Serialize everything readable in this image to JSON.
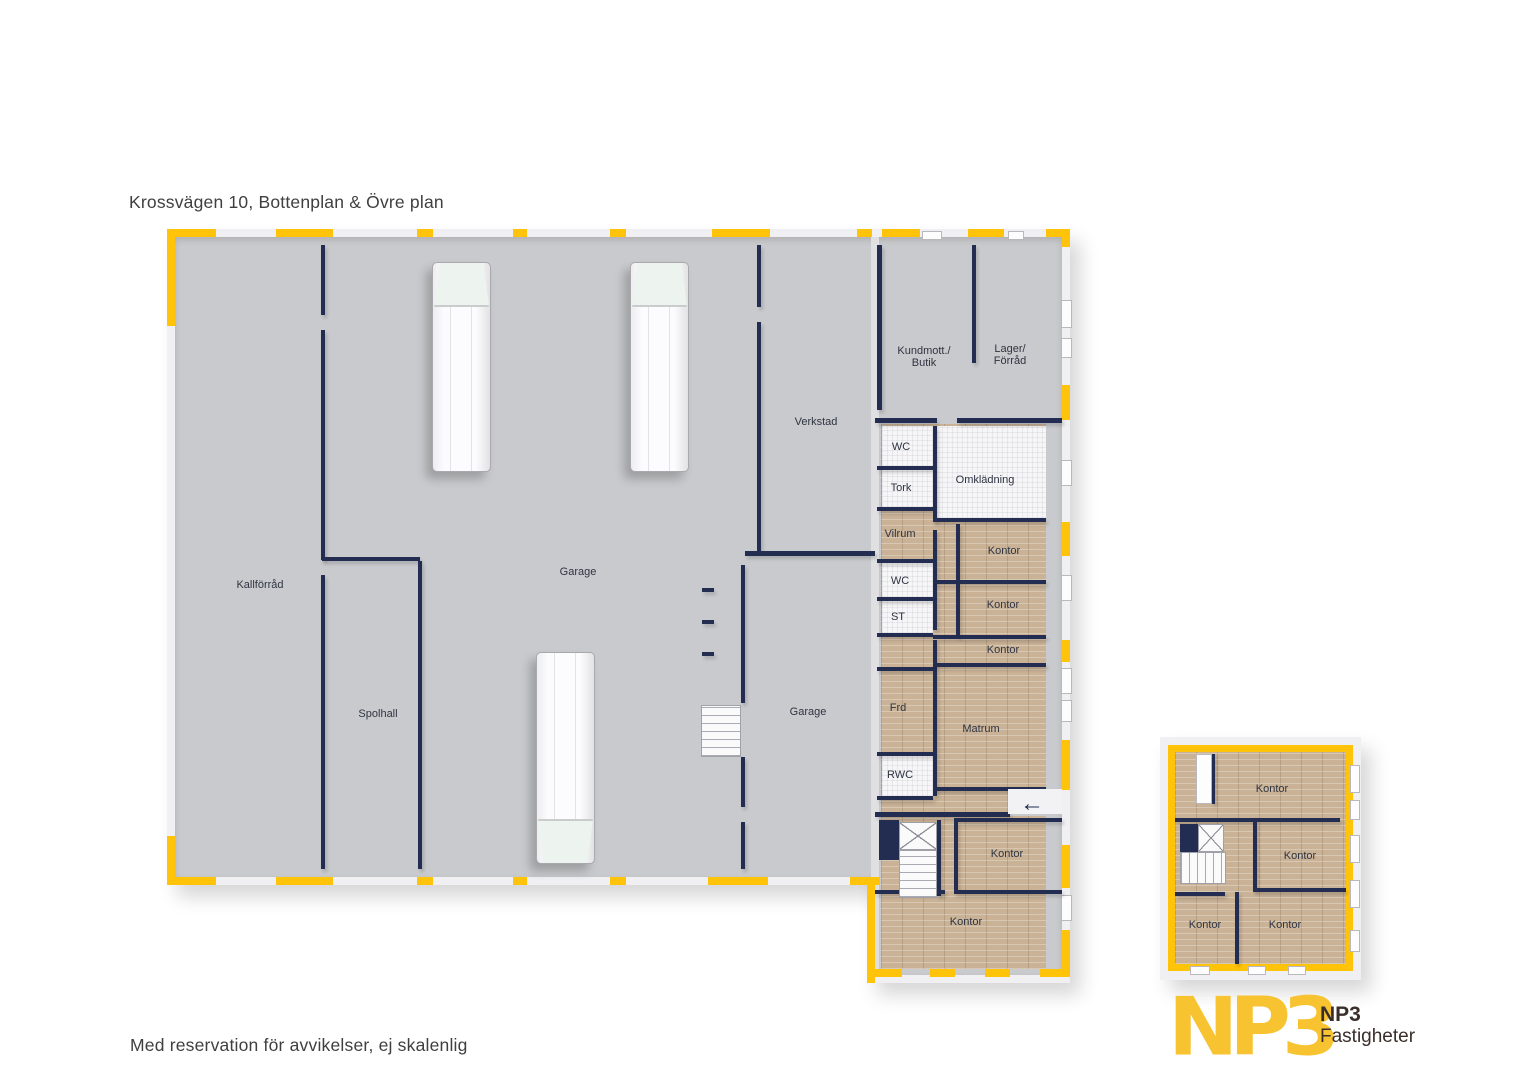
{
  "title": "Krossvägen 10, Bottenplan & Övre plan",
  "disclaimer": "Med reservation för avvikelser, ej skalenlig",
  "logo": {
    "mark": "NP3",
    "name": "NP3",
    "subtitle": "Fastigheter"
  },
  "icons": {
    "entrance_arrow": "←"
  },
  "colors": {
    "accent_yellow": "#FFC40A",
    "logo_yellow": "#F7C331",
    "wall_navy": "#232D52",
    "floor_grey": "#C9CACD",
    "floor_wood": "#C9B296",
    "floor_tile": "#F6F6F8"
  },
  "bottenplan": {
    "kallforrad": "Kallförråd",
    "spolhall": "Spolhall",
    "garage": "Garage",
    "verkstad": "Verkstad",
    "garage2": "Garage",
    "kundmott_1": "Kundmott./",
    "kundmott_2": "Butik",
    "lager_1": "Lager/",
    "lager_2": "Förråd",
    "wc1": "WC",
    "tork": "Tork",
    "omkladning": "Omklädning",
    "vilrum": "Vilrum",
    "wc2": "WC",
    "st": "ST",
    "kontor_a": "Kontor",
    "kontor_b": "Kontor",
    "kontor_c": "Kontor",
    "frd": "Frd",
    "matrum": "Matrum",
    "rwc": "RWC",
    "kontor_d": "Kontor",
    "kontor_e": "Kontor"
  },
  "ovreplan": {
    "kontor_1": "Kontor",
    "kontor_2": "Kontor",
    "kontor_3": "Kontor",
    "kontor_4": "Kontor"
  }
}
